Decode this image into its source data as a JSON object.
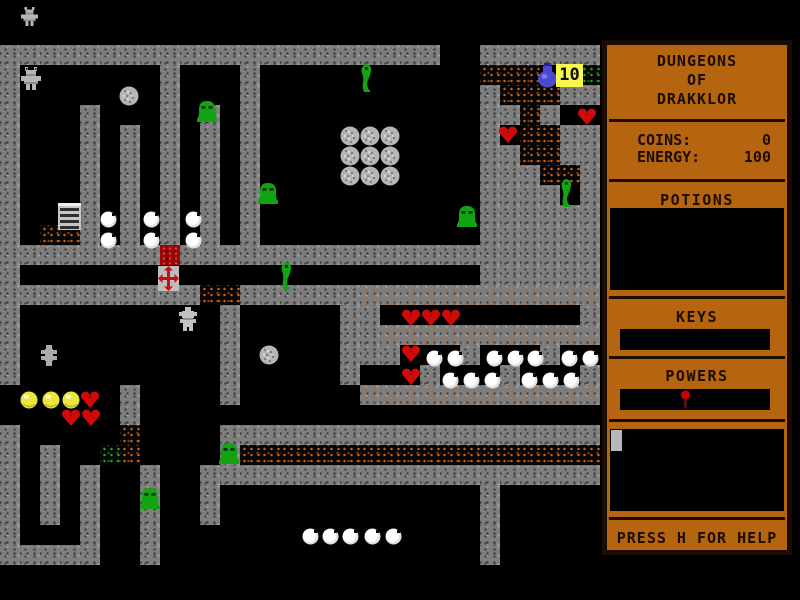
{
  "sidebar": {
    "title_lines": [
      "DUNGEONS",
      "OF",
      "DRAKKLOR"
    ],
    "coins_label": "COINS:",
    "coins_value": "0",
    "energy_label": "ENERGY:",
    "energy_value": "100",
    "potions_label": "POTIONS",
    "keys_label": "KEYS",
    "powers_label": "POWERS",
    "help_text": "PRESS H FOR HELP",
    "power_pin_icon": "red-pin",
    "inventory_item_icon": "gray-slab"
  },
  "colors": {
    "sidebar_bg": "#b5650f",
    "sidebar_text": "#1d0c00",
    "wall_gray": "#7e7e7e",
    "rubble_orange": "#c2611a",
    "rubble_green": "#2aa02a",
    "lava_red": "#9c0606",
    "heart_red": "#cf0a0a",
    "slime_green": "#12a412",
    "coin_yellow": "#eae63c",
    "potion_blue": "#4848d0",
    "pearl_white": "#ffffff",
    "boulder_gray": "#b5b5b5",
    "ten_tile_yellow": "#f8f84e"
  },
  "map": {
    "tile_size": 20,
    "origin": {
      "x": 0,
      "y": 45
    },
    "legend": {
      "#": "wall",
      "b": "orange-rubble",
      "g": "green-rubble",
      "r": "red-rubble",
      "m": "wall-rubble-mix",
      ".": "floor"
    },
    "rows": [
      "######################..######",
      "#.......#...#...........bbb..g",
      "#.......#...#...........#bbb##",
      "#...#...#.#.#...........##b#..",
      "#...#.#.#.#.#...........#.bb##",
      "#...#.#.#.#.#...........##bb##",
      "#...#.#.#.#.#...........###bb#",
      "#...#.#.#.#.#...........####.#",
      "#...#.#.#.#.#...........######",
      "#.bb#.#.#.#.#...........######",
      "########r#####################",
      "#.......................######",
      "##########bb######mmmmmmmmmmmm",
      "#..........#.....##..........#",
      "#..........#.....##mmmmmmmmmmm",
      "#..........#.....###...#...#..",
      "#..........#.....#...#...#...#",
      "......#....#......mmmmmmmmmmmm",
      "......#.......................",
      "#.....b....###################",
      "#.#..gb....#bbbbbbbbbbbbbbbbbb",
      "#.#.#..#..####################",
      "#.#.#..#..#.............#.....",
      "#.#.#..#..#.............#.....",
      "#...#..#................#.....",
      "#####..#................#....."
    ],
    "sprites": [
      {
        "type": "mini-player",
        "x": 21,
        "y": 6
      },
      {
        "type": "player",
        "x": 21,
        "y": 66
      },
      {
        "type": "boulder",
        "x": 119,
        "y": 86
      },
      {
        "type": "slime",
        "x": 196,
        "y": 98
      },
      {
        "type": "snake",
        "x": 358,
        "y": 63
      },
      {
        "type": "potion",
        "x": 534,
        "y": 63
      },
      {
        "type": "ten",
        "x": 556,
        "y": 64,
        "label": "10"
      },
      {
        "type": "heart",
        "x": 577,
        "y": 108
      },
      {
        "type": "heart",
        "x": 498,
        "y": 126
      },
      {
        "type": "boulder",
        "x": 340,
        "y": 126
      },
      {
        "type": "boulder",
        "x": 360,
        "y": 126
      },
      {
        "type": "boulder",
        "x": 380,
        "y": 126
      },
      {
        "type": "boulder",
        "x": 340,
        "y": 146
      },
      {
        "type": "boulder",
        "x": 360,
        "y": 146
      },
      {
        "type": "boulder",
        "x": 380,
        "y": 146
      },
      {
        "type": "boulder",
        "x": 340,
        "y": 166
      },
      {
        "type": "boulder",
        "x": 360,
        "y": 166
      },
      {
        "type": "boulder",
        "x": 380,
        "y": 166
      },
      {
        "type": "slime",
        "x": 257,
        "y": 180
      },
      {
        "type": "snake",
        "x": 558,
        "y": 178
      },
      {
        "type": "ladder",
        "x": 56,
        "y": 203
      },
      {
        "type": "pearl",
        "x": 100,
        "y": 211
      },
      {
        "type": "pearl",
        "x": 143,
        "y": 211
      },
      {
        "type": "pearl",
        "x": 185,
        "y": 211
      },
      {
        "type": "slime",
        "x": 456,
        "y": 203
      },
      {
        "type": "pearl",
        "x": 100,
        "y": 232
      },
      {
        "type": "pearl",
        "x": 143,
        "y": 232
      },
      {
        "type": "pearl",
        "x": 185,
        "y": 232
      },
      {
        "type": "cross",
        "x": 158,
        "y": 266
      },
      {
        "type": "snake",
        "x": 278,
        "y": 261
      },
      {
        "type": "golem",
        "x": 177,
        "y": 307
      },
      {
        "type": "heart",
        "x": 401,
        "y": 309
      },
      {
        "type": "heart",
        "x": 421,
        "y": 309
      },
      {
        "type": "heart",
        "x": 441,
        "y": 309
      },
      {
        "type": "heart",
        "x": 401,
        "y": 345
      },
      {
        "type": "pearl",
        "x": 426,
        "y": 350
      },
      {
        "type": "pearl",
        "x": 447,
        "y": 350
      },
      {
        "type": "pearl",
        "x": 486,
        "y": 350
      },
      {
        "type": "pearl",
        "x": 507,
        "y": 350
      },
      {
        "type": "pearl",
        "x": 527,
        "y": 350
      },
      {
        "type": "pearl",
        "x": 561,
        "y": 350
      },
      {
        "type": "pearl",
        "x": 582,
        "y": 350
      },
      {
        "type": "boulder",
        "x": 259,
        "y": 345
      },
      {
        "type": "spider",
        "x": 39,
        "y": 345
      },
      {
        "type": "heart",
        "x": 401,
        "y": 368
      },
      {
        "type": "pearl",
        "x": 442,
        "y": 372
      },
      {
        "type": "pearl",
        "x": 463,
        "y": 372
      },
      {
        "type": "pearl",
        "x": 484,
        "y": 372
      },
      {
        "type": "pearl",
        "x": 521,
        "y": 372
      },
      {
        "type": "pearl",
        "x": 542,
        "y": 372
      },
      {
        "type": "pearl",
        "x": 563,
        "y": 372
      },
      {
        "type": "coin",
        "x": 20,
        "y": 391
      },
      {
        "type": "coin",
        "x": 42,
        "y": 391
      },
      {
        "type": "coin",
        "x": 62,
        "y": 391
      },
      {
        "type": "heart",
        "x": 80,
        "y": 391
      },
      {
        "type": "heart",
        "x": 61,
        "y": 409
      },
      {
        "type": "heart",
        "x": 81,
        "y": 409
      },
      {
        "type": "slime",
        "x": 218,
        "y": 440
      },
      {
        "type": "slime",
        "x": 139,
        "y": 485
      },
      {
        "type": "pearl",
        "x": 302,
        "y": 528
      },
      {
        "type": "pearl",
        "x": 322,
        "y": 528
      },
      {
        "type": "pearl",
        "x": 342,
        "y": 528
      },
      {
        "type": "pearl",
        "x": 364,
        "y": 528
      },
      {
        "type": "pearl",
        "x": 385,
        "y": 528
      }
    ]
  }
}
